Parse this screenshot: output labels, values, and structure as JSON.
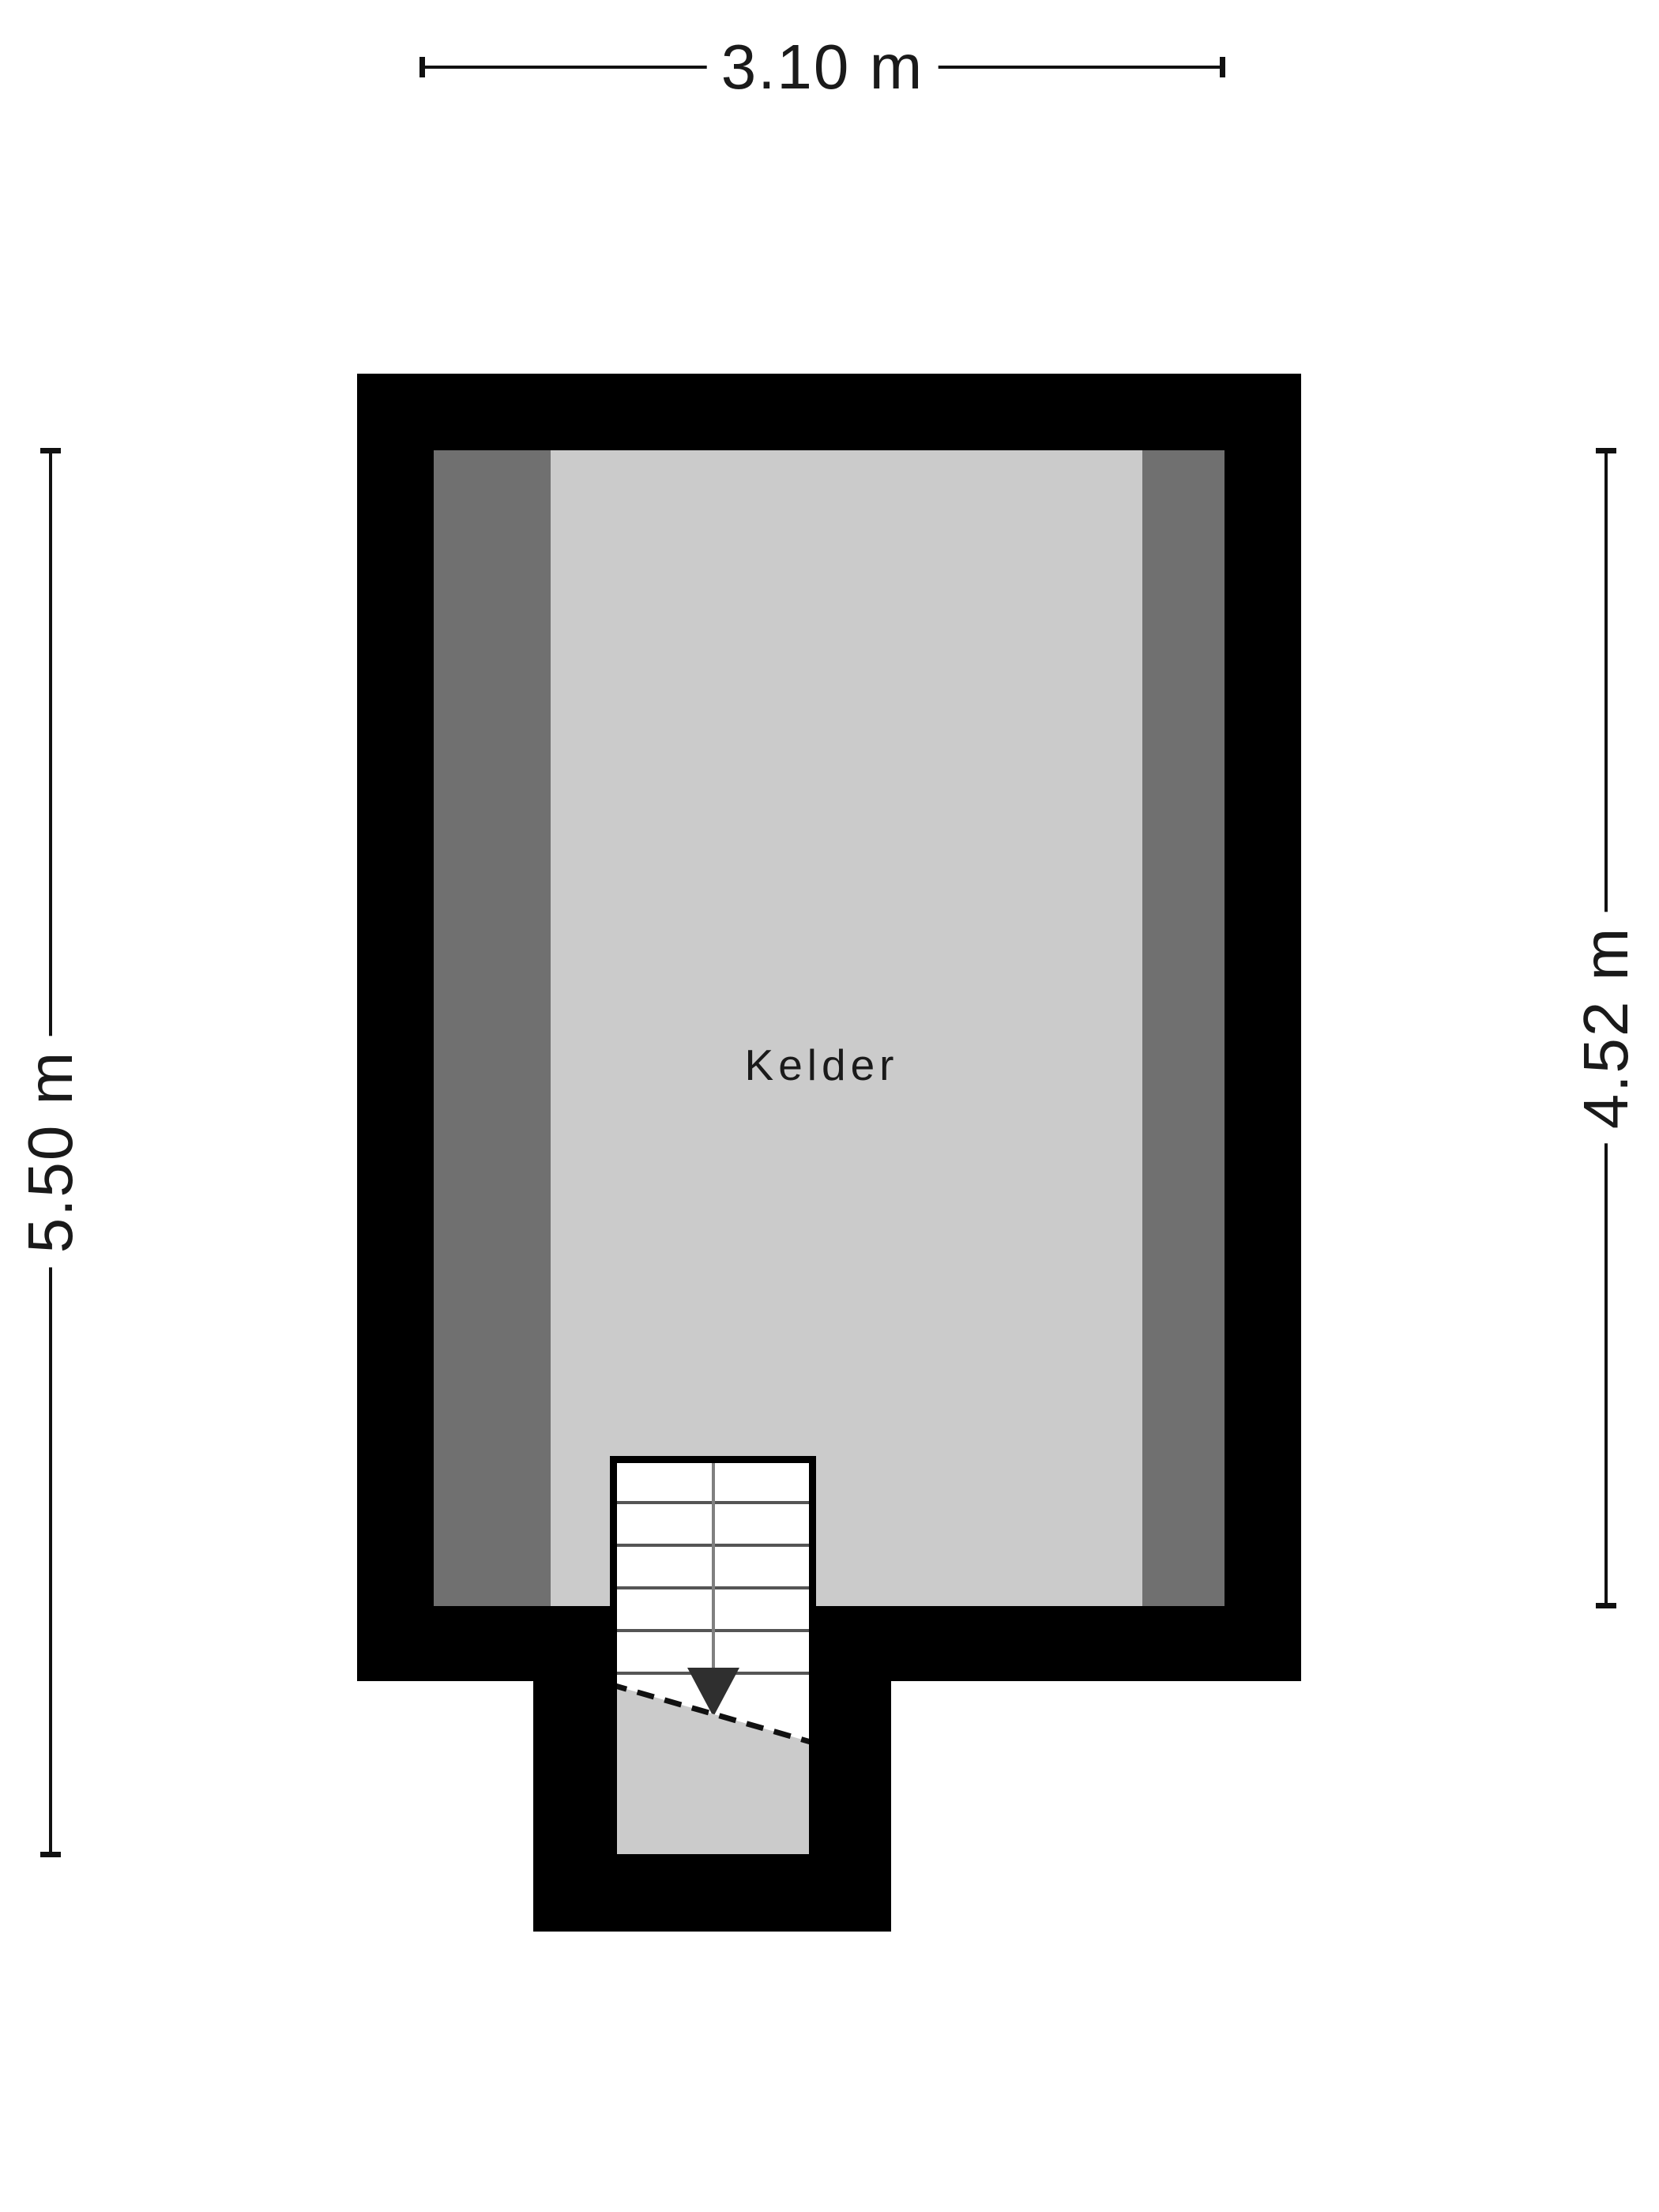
{
  "room": {
    "label": "Kelder"
  },
  "dimensions": {
    "top": {
      "label": "3.10 m"
    },
    "left": {
      "label": "5.50 m"
    },
    "right": {
      "label": "4.52 m"
    }
  },
  "colors": {
    "background": "#ffffff",
    "wall": "#000000",
    "floor": "#cbcbcb",
    "wall-shade": "#707070",
    "stair-bg": "#ffffff",
    "line": "#111111",
    "tread": "#555555",
    "walkline": "#808080",
    "arrow": "#2f2f2f",
    "text": "#1a1a1a"
  }
}
